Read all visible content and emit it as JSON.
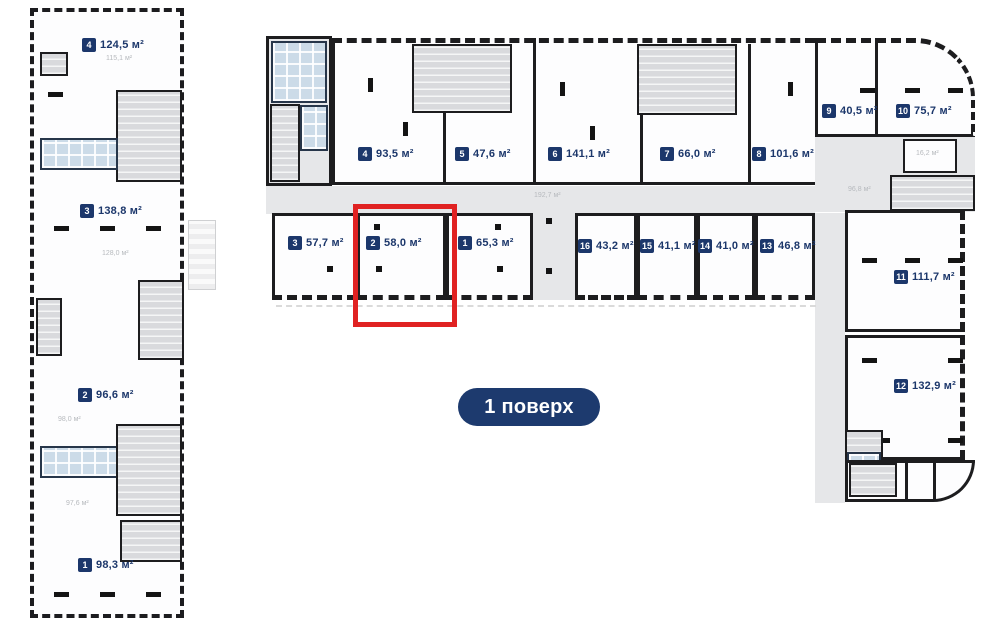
{
  "floor_badge": "1 поверх",
  "colors": {
    "accent": "#1c376b",
    "highlight": "#e02222"
  },
  "left_building": {
    "units": {
      "u4": {
        "num": "4",
        "area": "124,5 м²",
        "sub": "115,1 м²"
      },
      "u3": {
        "num": "3",
        "area": "138,8 м²",
        "sub": "128,0 м²"
      },
      "u2": {
        "num": "2",
        "area": "96,6 м²",
        "sub": "98,0 м²"
      },
      "u1": {
        "num": "1",
        "area": "98,3 м²",
        "sub": "97,6 м²"
      }
    }
  },
  "main_building": {
    "top_units": {
      "u4": {
        "num": "4",
        "area": "93,5 м²"
      },
      "u5": {
        "num": "5",
        "area": "47,6 м²"
      },
      "u6": {
        "num": "6",
        "area": "141,1 м²"
      },
      "u7": {
        "num": "7",
        "area": "66,0 м²"
      },
      "u8": {
        "num": "8",
        "area": "101,6 м²"
      },
      "u9": {
        "num": "9",
        "area": "40,5 м²"
      },
      "u10": {
        "num": "10",
        "area": "75,7 м²"
      }
    },
    "bottom_units": {
      "u3": {
        "num": "3",
        "area": "57,7 м²"
      },
      "u2": {
        "num": "2",
        "area": "58,0 м²",
        "highlighted": true
      },
      "u1": {
        "num": "1",
        "area": "65,3 м²"
      },
      "u16": {
        "num": "16",
        "area": "43,2 м²"
      },
      "u15": {
        "num": "15",
        "area": "41,1 м²"
      },
      "u14": {
        "num": "14",
        "area": "41,0 м²"
      },
      "u13": {
        "num": "13",
        "area": "46,8 м²"
      }
    },
    "right_units": {
      "u11": {
        "num": "11",
        "area": "111,7 м²"
      },
      "u12": {
        "num": "12",
        "area": "132,9 м²"
      }
    },
    "corridors": {
      "main": "192,7 м²",
      "right": "96,8 м²",
      "small_room": "16,2 м²"
    }
  }
}
